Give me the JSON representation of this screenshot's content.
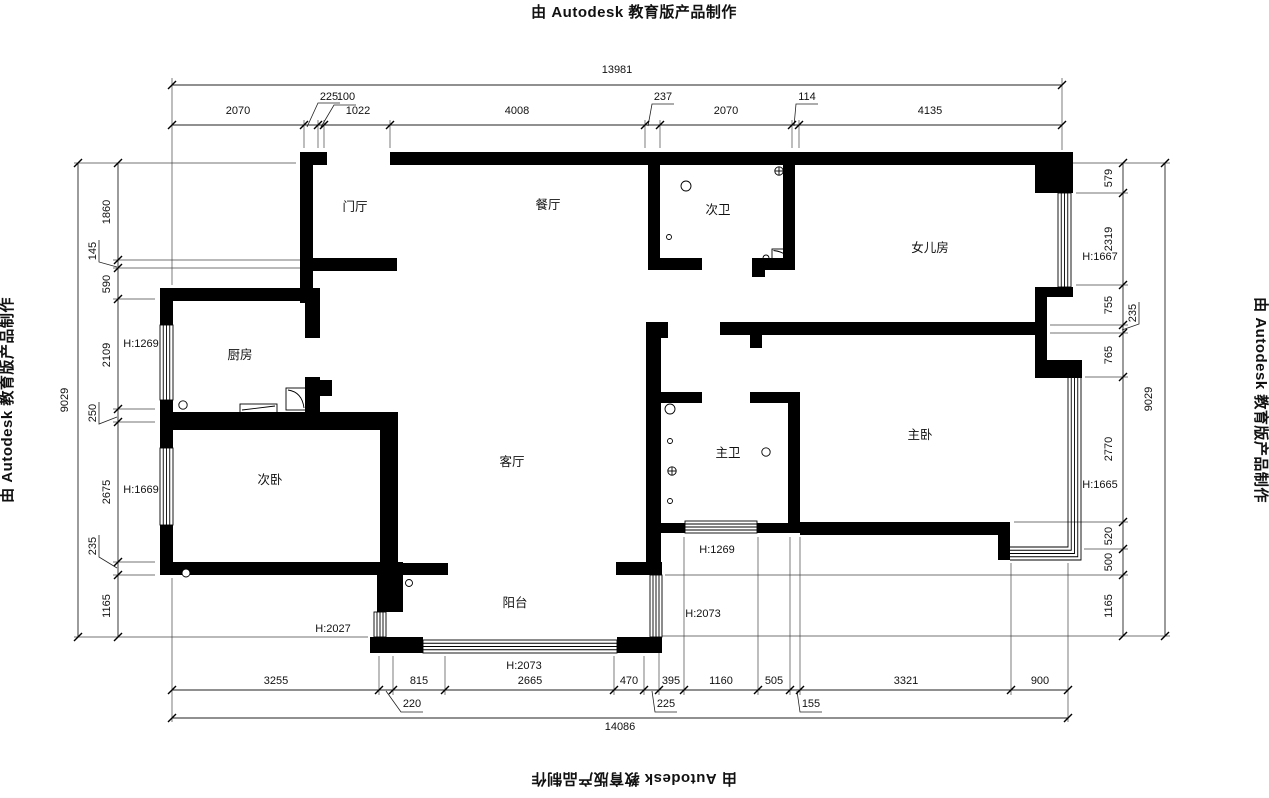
{
  "watermark": {
    "text": "由 Autodesk 教育版产品制作"
  },
  "rooms": [
    {
      "label": "门厅",
      "x": 355,
      "y": 211
    },
    {
      "label": "餐厅",
      "x": 548,
      "y": 209
    },
    {
      "label": "次卫",
      "x": 718,
      "y": 214
    },
    {
      "label": "女儿房",
      "x": 930,
      "y": 252
    },
    {
      "label": "厨房",
      "x": 240,
      "y": 359
    },
    {
      "label": "次卧",
      "x": 270,
      "y": 484
    },
    {
      "label": "客厅",
      "x": 512,
      "y": 466
    },
    {
      "label": "主卫",
      "x": 728,
      "y": 457
    },
    {
      "label": "主卧",
      "x": 920,
      "y": 439
    },
    {
      "label": "阳台",
      "x": 515,
      "y": 607
    }
  ],
  "height_labels": [
    {
      "label": "H:1269",
      "x": 141,
      "y": 347
    },
    {
      "label": "H:1669",
      "x": 141,
      "y": 493
    },
    {
      "label": "H:1667",
      "x": 1100,
      "y": 260
    },
    {
      "label": "H:1665",
      "x": 1100,
      "y": 488
    },
    {
      "label": "H:1269",
      "x": 717,
      "y": 553
    },
    {
      "label": "H:2073",
      "x": 703,
      "y": 617
    },
    {
      "label": "H:2027",
      "x": 333,
      "y": 632
    },
    {
      "label": "H:2073",
      "x": 524,
      "y": 669
    }
  ],
  "dimensions": {
    "top": {
      "total": {
        "v": "13981",
        "x": 617,
        "y": 73
      },
      "labels": [
        {
          "v": "2070",
          "x": 238,
          "y": 114
        },
        {
          "v": "225",
          "x": 329,
          "y": 100
        },
        {
          "v": "100",
          "x": 346,
          "y": 100
        },
        {
          "v": "1022",
          "x": 358,
          "y": 114
        },
        {
          "v": "4008",
          "x": 517,
          "y": 114
        },
        {
          "v": "237",
          "x": 663,
          "y": 100
        },
        {
          "v": "2070",
          "x": 726,
          "y": 114
        },
        {
          "v": "114",
          "x": 807,
          "y": 100
        },
        {
          "v": "4135",
          "x": 930,
          "y": 114
        }
      ]
    },
    "bottom": {
      "total": {
        "v": "14086",
        "x": 620,
        "y": 730
      },
      "labels": [
        {
          "v": "3255",
          "x": 276,
          "y": 684
        },
        {
          "v": "815",
          "x": 419,
          "y": 684
        },
        {
          "v": "2665",
          "x": 530,
          "y": 684
        },
        {
          "v": "470",
          "x": 629,
          "y": 684
        },
        {
          "v": "395",
          "x": 671,
          "y": 684
        },
        {
          "v": "1160",
          "x": 721,
          "y": 684
        },
        {
          "v": "505",
          "x": 774,
          "y": 684
        },
        {
          "v": "3321",
          "x": 906,
          "y": 684
        },
        {
          "v": "900",
          "x": 1040,
          "y": 684
        },
        {
          "v": "220",
          "x": 412,
          "y": 707
        },
        {
          "v": "225",
          "x": 666,
          "y": 707
        },
        {
          "v": "155",
          "x": 811,
          "y": 707
        }
      ]
    },
    "left": {
      "total": {
        "v": "9029",
        "x": 68,
        "y": 400
      },
      "labels": [
        {
          "v": "1860",
          "x": 110,
          "y": 212
        },
        {
          "v": "145",
          "x": 96,
          "y": 251
        },
        {
          "v": "590",
          "x": 110,
          "y": 284
        },
        {
          "v": "2109",
          "x": 110,
          "y": 355
        },
        {
          "v": "250",
          "x": 96,
          "y": 413
        },
        {
          "v": "2675",
          "x": 110,
          "y": 492
        },
        {
          "v": "235",
          "x": 96,
          "y": 546
        },
        {
          "v": "1165",
          "x": 110,
          "y": 606
        }
      ]
    },
    "right": {
      "total": {
        "v": "9029",
        "x": 1152,
        "y": 399
      },
      "labels": [
        {
          "v": "579",
          "x": 1112,
          "y": 178
        },
        {
          "v": "2319",
          "x": 1112,
          "y": 239
        },
        {
          "v": "755",
          "x": 1112,
          "y": 305
        },
        {
          "v": "235",
          "x": 1136,
          "y": 313
        },
        {
          "v": "765",
          "x": 1112,
          "y": 355
        },
        {
          "v": "2770",
          "x": 1112,
          "y": 449
        },
        {
          "v": "520",
          "x": 1112,
          "y": 536
        },
        {
          "v": "500",
          "x": 1112,
          "y": 562
        },
        {
          "v": "1165",
          "x": 1112,
          "y": 606
        }
      ]
    }
  }
}
